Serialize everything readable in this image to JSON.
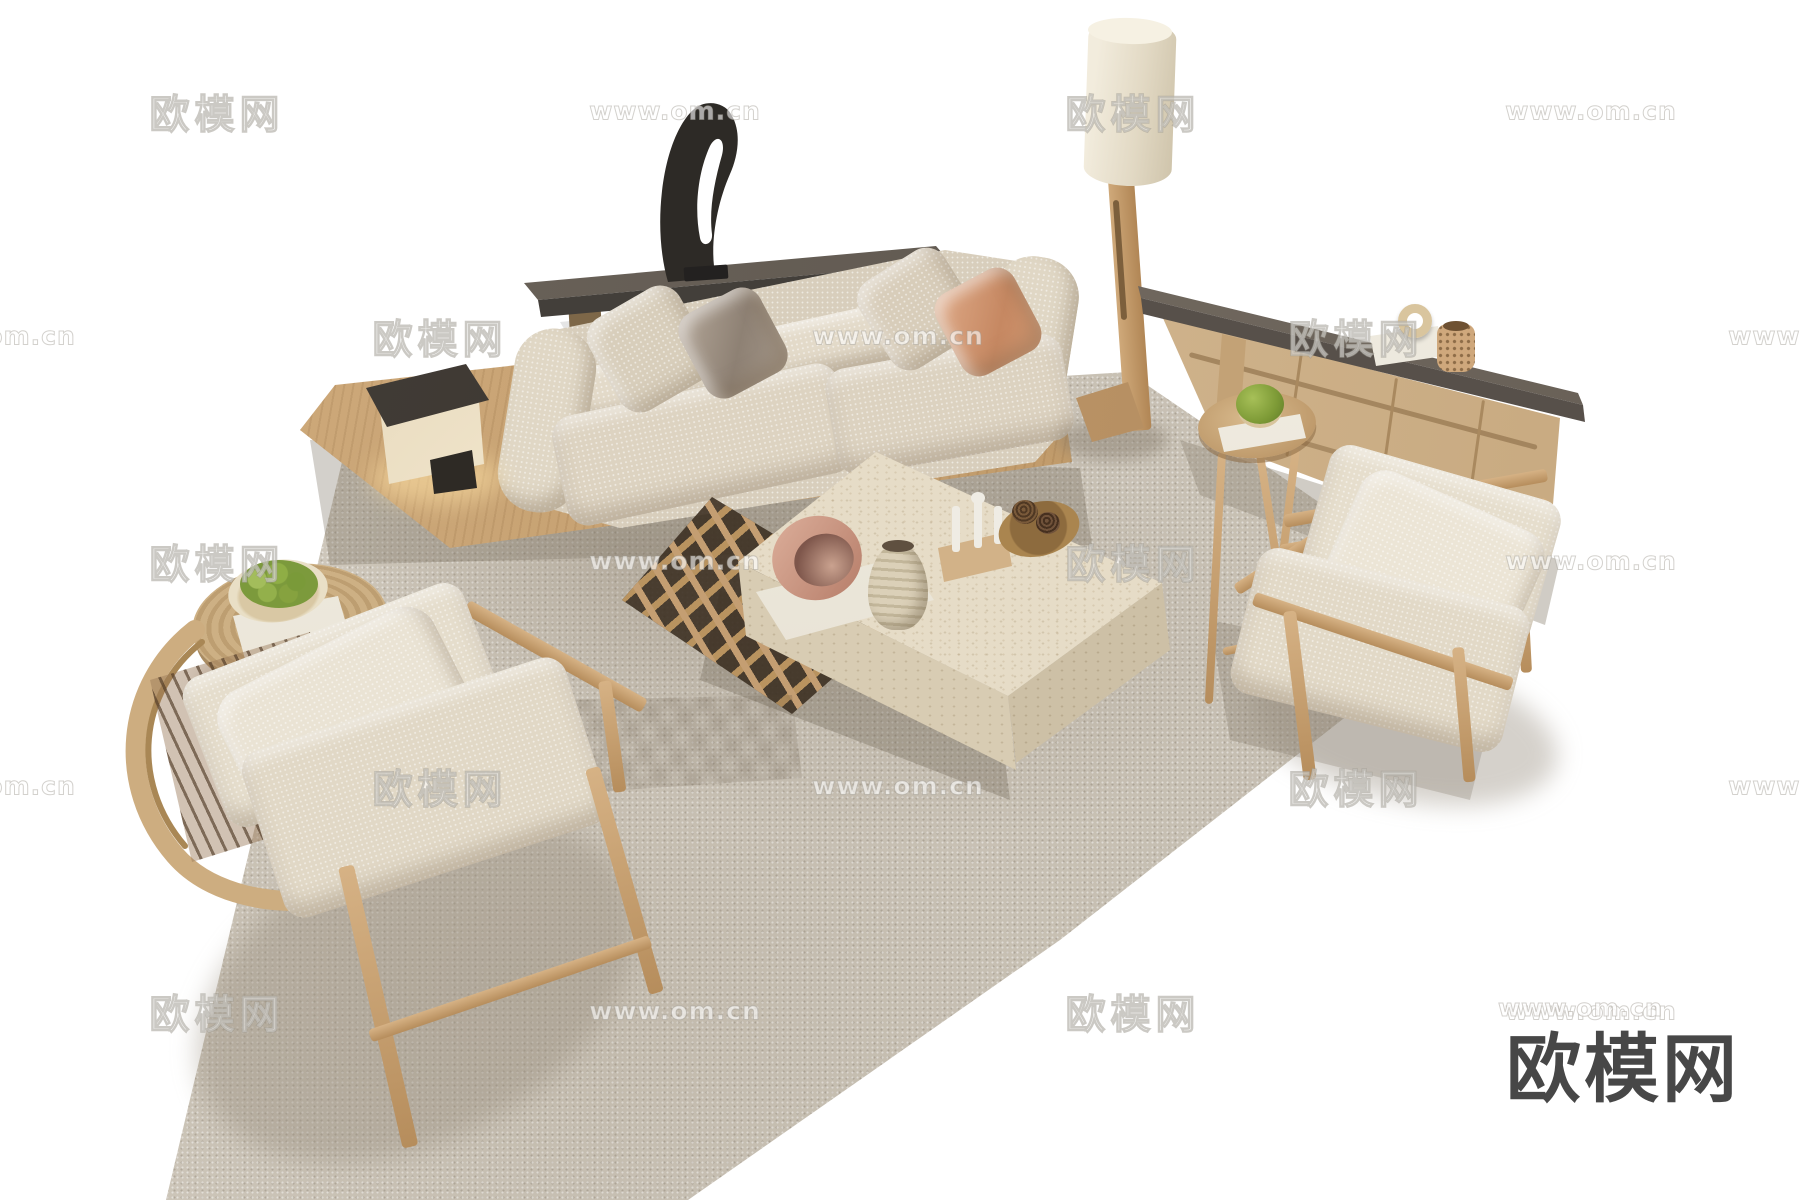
{
  "canvas": {
    "width": 1800,
    "height": 1200,
    "background": "#ffffff"
  },
  "watermarks": {
    "logo_text": "欧模网",
    "url_text": "www.om.cn",
    "tile_rows": [
      {
        "y": 111,
        "tiles": [
          {
            "x": 217,
            "type": "logo"
          },
          {
            "x": 675,
            "type": "url"
          },
          {
            "x": 1133,
            "type": "logo"
          },
          {
            "x": 1591,
            "type": "url"
          }
        ]
      },
      {
        "y": 336,
        "tiles": [
          {
            "x": -10,
            "type": "url"
          },
          {
            "x": 440,
            "type": "logo"
          },
          {
            "x": 898,
            "type": "url"
          },
          {
            "x": 1356,
            "type": "logo"
          },
          {
            "x": 1814,
            "type": "url"
          }
        ]
      },
      {
        "y": 561,
        "tiles": [
          {
            "x": 217,
            "type": "logo"
          },
          {
            "x": 675,
            "type": "url"
          },
          {
            "x": 1133,
            "type": "logo"
          },
          {
            "x": 1591,
            "type": "url"
          }
        ]
      },
      {
        "y": 786,
        "tiles": [
          {
            "x": -10,
            "type": "url"
          },
          {
            "x": 440,
            "type": "logo"
          },
          {
            "x": 898,
            "type": "url"
          },
          {
            "x": 1356,
            "type": "logo"
          },
          {
            "x": 1814,
            "type": "url"
          }
        ]
      },
      {
        "y": 1011,
        "tiles": [
          {
            "x": 217,
            "type": "logo"
          },
          {
            "x": 675,
            "type": "url"
          },
          {
            "x": 1133,
            "type": "logo"
          },
          {
            "x": 1591,
            "type": "url"
          }
        ]
      }
    ],
    "corner_logo_text": "欧模网",
    "corner_url_text": "www.om.cn",
    "corner_logo_color": "#474747"
  },
  "palette": {
    "floor": "#ffffff",
    "rug": "#cbc3b5",
    "wood_light": "#cfae82",
    "wood_platform": "#c9a477",
    "fabric_cream": "#e0d7c6",
    "pillow_satin": "#a3968a",
    "pillow_terracotta": "#d69d7b",
    "console_top": "#6e665d",
    "sideboard_top": "#776e65",
    "sideboard_body": "#d9c19d",
    "travertine": "#e5dbc6",
    "sculpture_black": "#2d2a26",
    "moss_green": "#86a23f",
    "blush_bowl": "#cf9e8b",
    "lamp_shade": "#ece4d2"
  },
  "scene": {
    "description": "Top-down 3D render of a modern beige living-room furniture set on a large taupe rug over a white floor",
    "objects": [
      {
        "id": "rug",
        "label": "large taupe area rug"
      },
      {
        "id": "sofa",
        "label": "three-seat cream fabric sofa on wood platform"
      },
      {
        "id": "console",
        "label": "dark shelf console behind sofa"
      },
      {
        "id": "sculpture",
        "label": "black abstract sculpture"
      },
      {
        "id": "table-lamp",
        "label": "cube table lamp"
      },
      {
        "id": "floor-lamp",
        "label": "wood floor lamp with drum shade"
      },
      {
        "id": "sideboard",
        "label": "wood sideboard with dark top"
      },
      {
        "id": "side-table-right",
        "label": "tall round wood side table with moss bowl and books"
      },
      {
        "id": "coffee-table",
        "label": "travertine block coffee table with vases and tray"
      },
      {
        "id": "lattice-table",
        "label": "wood lattice tray table"
      },
      {
        "id": "side-table-left",
        "label": "round jute side table with fruit plate and book"
      },
      {
        "id": "armchair-left",
        "label": "wood frame lounge armchair with cream cushions"
      },
      {
        "id": "armchair-right",
        "label": "wood frame lounge armchair with cream cushions"
      }
    ]
  }
}
